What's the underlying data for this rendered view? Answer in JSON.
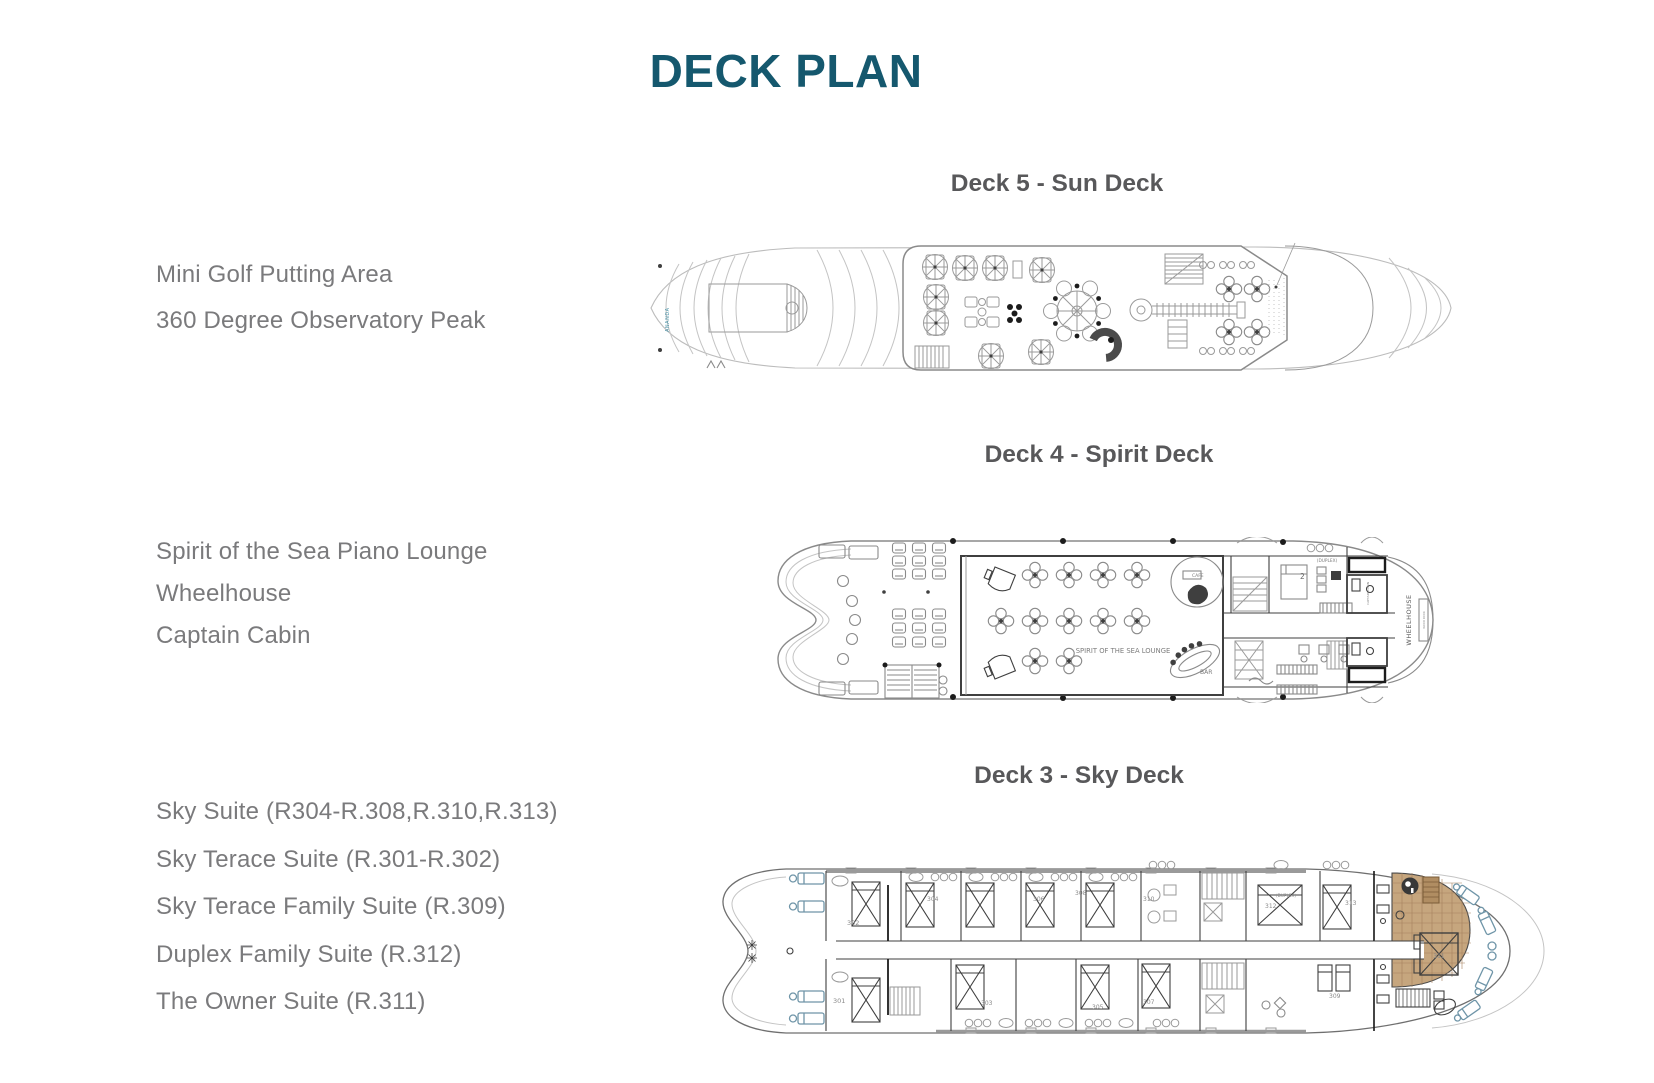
{
  "page": {
    "title": "DECK PLAN"
  },
  "colors": {
    "title": "#15586E",
    "heading": "#58585A",
    "label": "#7A7A7C",
    "accent_teal": "#4B93A7",
    "terrace_tan": "#C6A67E",
    "lounger_blue": "#6F95A8"
  },
  "decks": [
    {
      "header": "Deck 5 - Sun Deck",
      "features": [
        "Mini Golf Putting Area",
        "360 Degree Observatory Peak"
      ],
      "plan_text": {
        "brand": "ANANDA"
      }
    },
    {
      "header": "Deck 4 - Spirit Deck",
      "features": [
        "Spirit of the Sea Piano Lounge",
        "Wheelhouse",
        "Captain Cabin"
      ],
      "plan_text": {
        "lounge": "SPIRIT OF THE SEA LOUNGE",
        "bar": "BAR",
        "cafe": "CAFE",
        "duplex": "(DUPLEX)",
        "duplex_number": "2",
        "captain_cabin": "CAPTAIN CABIN",
        "wheelhouse": "WHEELHOUSE",
        "wood_door": "WOOD DOOR"
      }
    },
    {
      "header": "Deck 3 - Sky Deck",
      "features": [
        "Sky Suite (R304-R.308,R.310,R.313)",
        "Sky Terace Suite (R.301-R.302)",
        "Sky Terace Family Suite (R.309)",
        "Duplex Family Suite (R.312)",
        "The Owner Suite (R.311)"
      ],
      "plan_text": {
        "duplex": "(DUPLEX)",
        "bow_suite": "302",
        "owner_suite": "311",
        "rooms_top": [
          "304",
          "306",
          "308",
          "310",
          "312",
          "313"
        ],
        "rooms_bottom": [
          "301",
          "303",
          "305",
          "307",
          "309"
        ]
      }
    }
  ]
}
